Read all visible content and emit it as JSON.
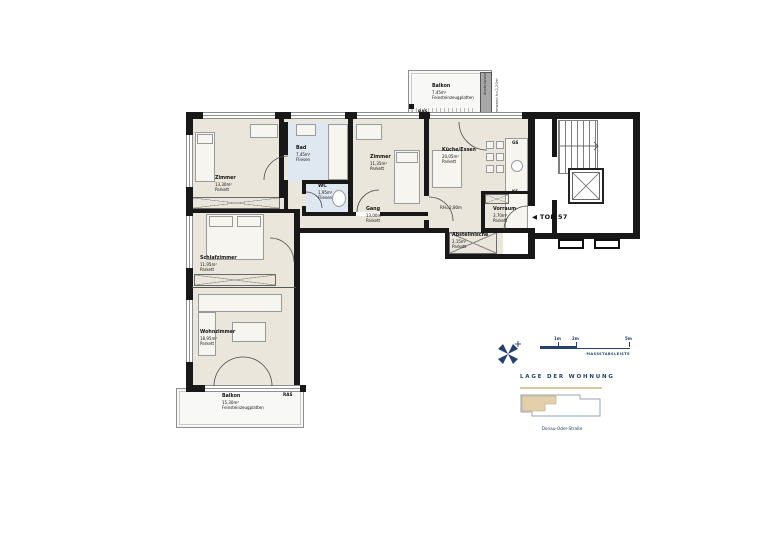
{
  "plan": {
    "top_marker": "◀ TOP 57",
    "rooms": [
      {
        "id": "zimmer-west",
        "name": "Zimmer",
        "area": "13,30m²",
        "floor": "Parkett"
      },
      {
        "id": "bad",
        "name": "Bad",
        "area": "7,45m²",
        "floor": "Fliesen"
      },
      {
        "id": "wc",
        "name": "WC",
        "area": "1,95m²",
        "floor": "Fliesen"
      },
      {
        "id": "zimmer-ost",
        "name": "Zimmer",
        "area": "11,35m²",
        "floor": "Parkett"
      },
      {
        "id": "kueche-essen",
        "name": "Küche/Essen",
        "area": "20,05m²",
        "floor": "Parkett"
      },
      {
        "id": "gang",
        "name": "Gang",
        "area": "13,00m²",
        "floor": "Parkett"
      },
      {
        "id": "vorraum",
        "name": "Vorraum",
        "area": "3,70m²",
        "floor": "Parkett"
      },
      {
        "id": "abstellnische",
        "name": "Abstellnische",
        "area": "2,15m²",
        "floor": "Parkett"
      },
      {
        "id": "schlafzimmer",
        "name": "Schlafzimmer",
        "area": "11,95m²",
        "floor": "Parkett"
      },
      {
        "id": "wohnzimmer",
        "name": "Wohnzimmer",
        "area": "18,95m²",
        "floor": "Parkett"
      },
      {
        "id": "balkon-nord",
        "name": "Balkon",
        "area": "7,45m²",
        "floor": "Feinsteinzeugplatten"
      },
      {
        "id": "balkon-sued",
        "name": "Balkon",
        "area": "15,30m²",
        "floor": "Feinsteinzeugplatten"
      }
    ],
    "annotations": {
      "room_height": "RH=2,80m",
      "dishwasher": "GS",
      "fridge": "KS",
      "ras_north": "RAS",
      "ras_south": "RAS",
      "balcony_partition": "Abstellplatz",
      "balcony_partition_note": "Trennwand h=2,20m"
    }
  },
  "legend": {
    "scale": {
      "ticks": [
        "1m",
        "2m",
        "5m"
      ],
      "label": "MASSSTABSLEISTE"
    },
    "location": {
      "title": "LAGE DER WOHNUNG",
      "street": "Donau-Oder-Straße"
    }
  },
  "colors": {
    "wall": "#181818",
    "room": "#eae6db",
    "wet_room": "#dfe7f0",
    "navy": "#24406e",
    "gold": "#dcc79f",
    "site_highlight": "#e3cfa9"
  }
}
